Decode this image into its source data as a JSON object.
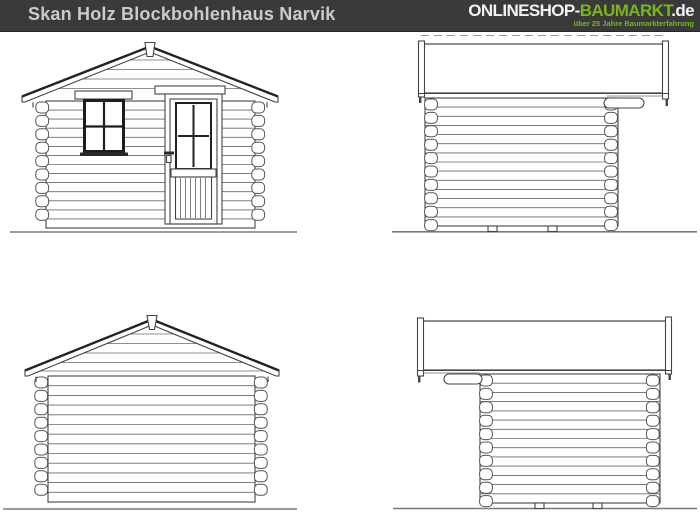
{
  "header": {
    "title": "Skan Holz Blockbohlenhaus Narvik",
    "logo": {
      "part_shop": "ONLINESHOP-",
      "part_baumarkt": "BAUMARKT",
      "part_de": ".de",
      "tagline": "über 25 Jahre Baumarkterfahrung"
    },
    "colors": {
      "bar_background": "#3a3a3a",
      "title_text": "#cbcbcb",
      "logo_light": "#f2f2f2",
      "logo_green": "#7ab51d"
    }
  },
  "drawing": {
    "line_color": "#444444",
    "ground_color": "#7a7a7a",
    "background": "#ffffff"
  }
}
